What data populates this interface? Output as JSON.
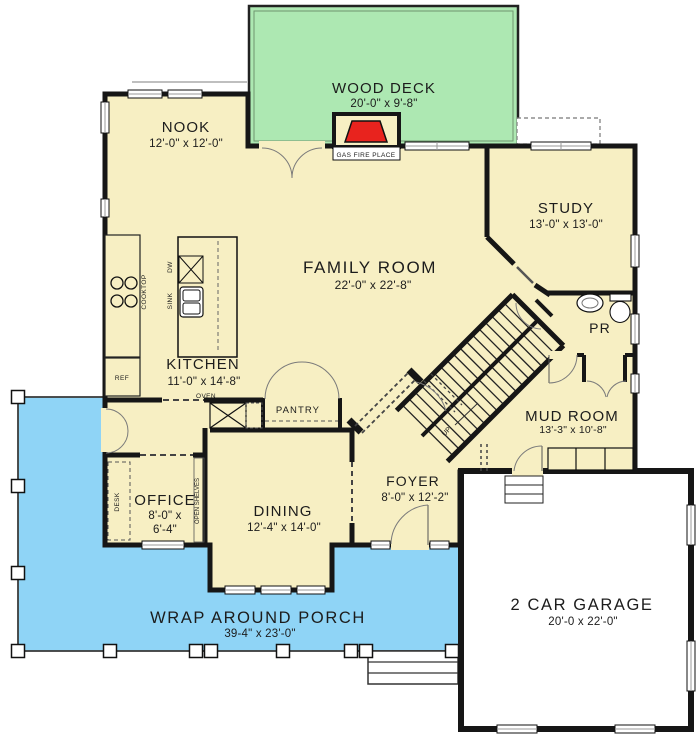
{
  "colors": {
    "floor": "#F7EFC3",
    "deck": "#ADE8B2",
    "porch": "#8FD4F6",
    "fire": "#E8231E",
    "wall": "#161616",
    "bg": "#FFFFFF"
  },
  "rooms": {
    "deck": {
      "name": "WOOD DECK",
      "dims": "20'-0\" x 9'-8\""
    },
    "nook": {
      "name": "NOOK",
      "dims": "12'-0\" x 12'-0\""
    },
    "family": {
      "name": "FAMILY ROOM",
      "dims": "22'-0\" x 22'-8\""
    },
    "study": {
      "name": "STUDY",
      "dims": "13'-0\" x 13'-0\""
    },
    "kitchen": {
      "name": "KITCHEN",
      "dims": "11'-0\" x 14'-8\""
    },
    "pr": {
      "name": "PR"
    },
    "mud": {
      "name": "MUD ROOM",
      "dims": "13'-3\" x 10'-8\""
    },
    "foyer": {
      "name": "FOYER",
      "dims": "8'-0\" x 12'-2\""
    },
    "office": {
      "name": "OFFICE",
      "dims1": "8'-0\" x",
      "dims2": "6'-4\""
    },
    "dining": {
      "name": "DINING",
      "dims": "12'-4\" x 14'-0\""
    },
    "porch": {
      "name": "WRAP AROUND PORCH",
      "dims": "39-4\" x 23'-0\""
    },
    "garage": {
      "name": "2 CAR GARAGE",
      "dims": "20'-0 x 22'-0\""
    },
    "pantry": {
      "name": "PANTRY"
    }
  },
  "labels": {
    "fireplace": "GAS FIRE PLACE",
    "cooktop": "COOKTOP",
    "sink": "SINK",
    "dw": "DW",
    "ref": "REF",
    "oven": "OVEN",
    "desk": "DESK",
    "shelves": "OPEN SHELVES",
    "up": "UP"
  }
}
